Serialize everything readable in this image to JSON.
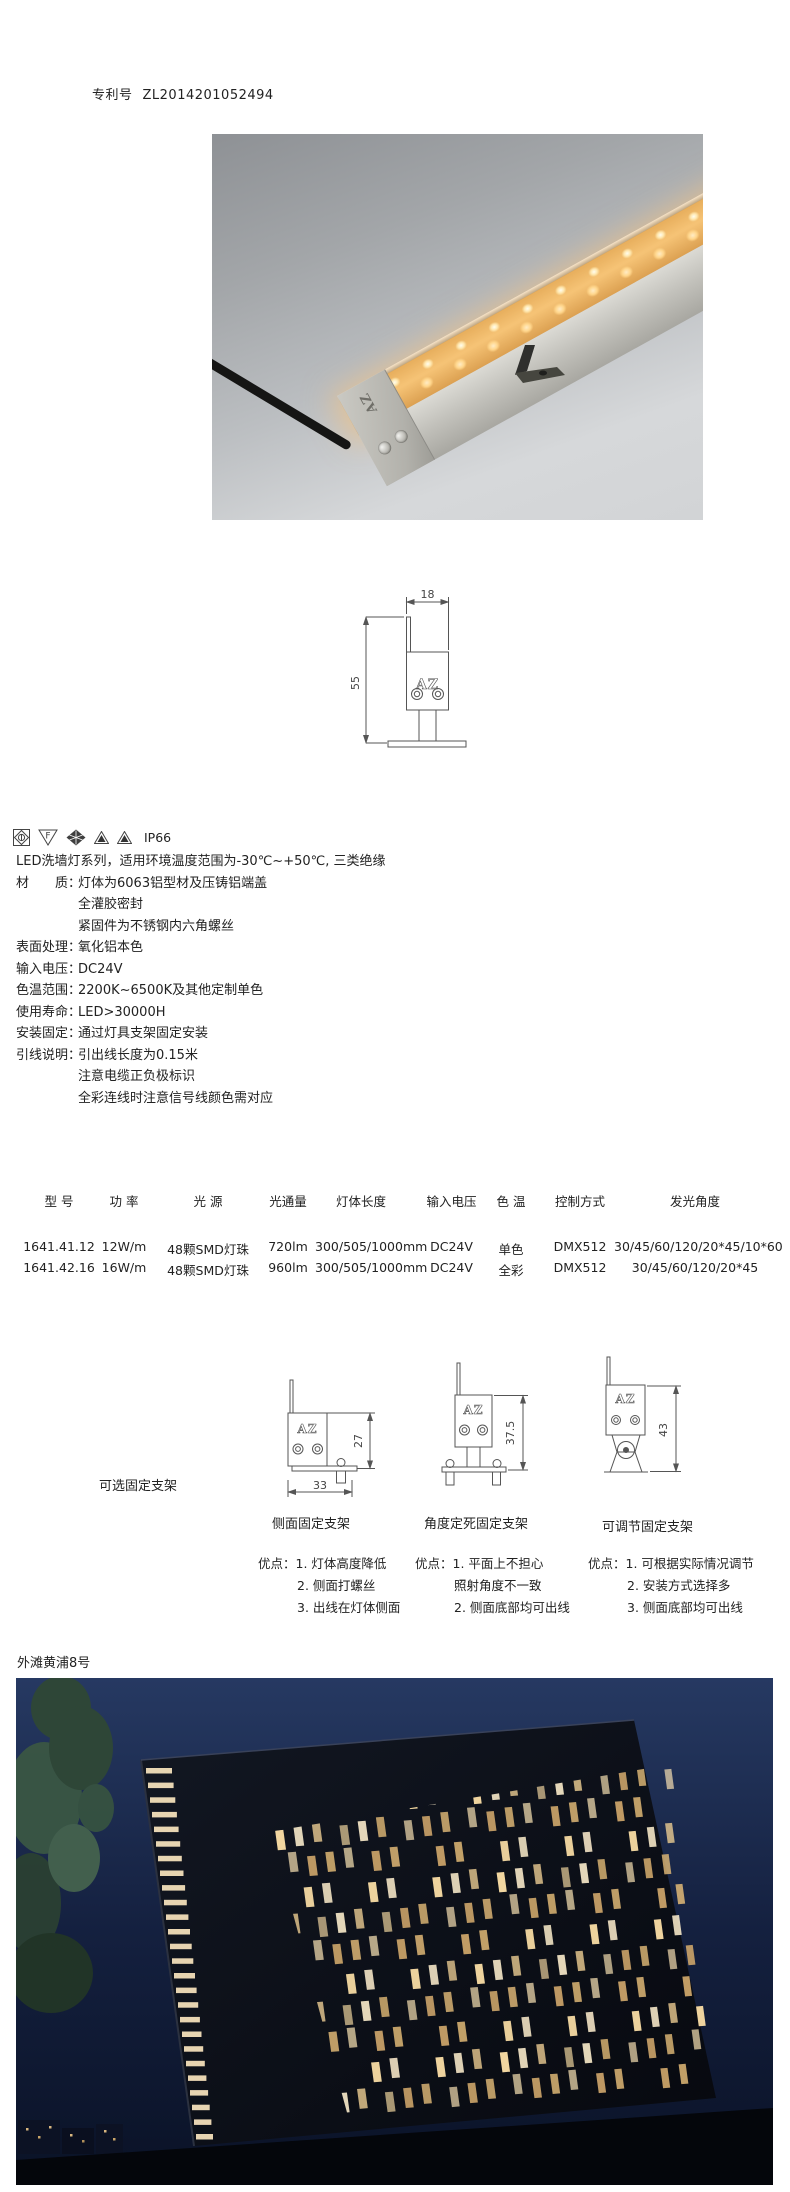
{
  "patent": {
    "label": "专利号",
    "number": "ZL2014201052494"
  },
  "brand": {
    "logo": "AZ"
  },
  "certifications": {
    "ip_rating": "IP66",
    "f_mark": "F",
    "icons": [
      "diamond-lens-mark",
      "f-triangle-mark",
      "diamond-mesh-mark",
      "flame-triangle-mark",
      "flame-triangle-mark"
    ]
  },
  "description": {
    "intro": "LED洗墙灯系列，适用环境温度范围为-30℃~+50℃, 三类绝缘",
    "rows": [
      {
        "label": "材　　质：",
        "value": "灯体为6063铝型材及压铸铝端盖"
      },
      {
        "label": "",
        "value": "全灌胶密封"
      },
      {
        "label": "",
        "value": "紧固件为不锈钢内六角螺丝"
      },
      {
        "label": "表面处理：",
        "value": "氧化铝本色"
      },
      {
        "label": "输入电压：",
        "value": "DC24V"
      },
      {
        "label": "色温范围：",
        "value": "2200K~6500K及其他定制单色"
      },
      {
        "label": "使用寿命：",
        "value": "LED>30000H"
      },
      {
        "label": "安装固定：",
        "value": "通过灯具支架固定安装"
      },
      {
        "label": "引线说明：",
        "value": "引出线长度为0.15米"
      },
      {
        "label": "",
        "value": "注意电缆正负极标识"
      },
      {
        "label": "",
        "value": "全彩连线时注意信号线颜色需对应"
      }
    ]
  },
  "dimension_drawing": {
    "width_label": "18",
    "height_label": "55"
  },
  "spec_table": {
    "headers": [
      "型 号",
      "功 率",
      "光 源",
      "光通量",
      "灯体长度",
      "输入电压",
      "色 温",
      "控制方式",
      "发光角度"
    ],
    "rows": [
      [
        "1641.41.12",
        "12W/m",
        "48颗SMD灯珠",
        "720lm",
        "300/505/1000mm",
        "DC24V",
        "单色",
        "DMX512",
        "30/45/60/120/20*45/10*60"
      ],
      [
        "1641.42.16",
        "16W/m",
        "48颗SMD灯珠",
        "960lm",
        "300/505/1000mm",
        "DC24V",
        "全彩",
        "DMX512",
        "30/45/60/120/20*45"
      ]
    ]
  },
  "brackets": {
    "section_label": "可选固定支架",
    "options": [
      {
        "caption": "侧面固定支架",
        "height_dim": "27",
        "width_dim": "33",
        "advantages_label": "优点：",
        "advantages": [
          "1. 灯体高度降低",
          "2. 侧面打螺丝",
          "3. 出线在灯体侧面"
        ]
      },
      {
        "caption": "角度定死固定支架",
        "height_dim": "37.5",
        "advantages_label": "优点：",
        "advantages": [
          "1. 平面上不担心",
          "照射角度不一致",
          "2. 侧面底部均可出线"
        ]
      },
      {
        "caption": "可调节固定支架",
        "height_dim": "43",
        "advantages_label": "优点：",
        "advantages": [
          "1. 可根据实际情况调节",
          "2. 安装方式选择多",
          "3. 侧面底部均可出线"
        ]
      }
    ]
  },
  "project": {
    "caption": "外滩黄浦8号"
  }
}
